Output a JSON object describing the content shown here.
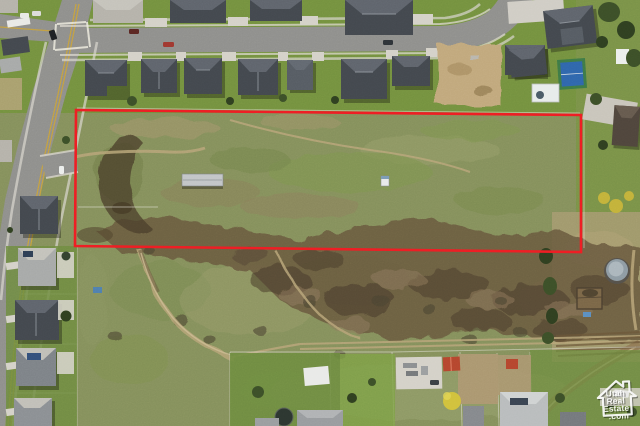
{
  "scene": {
    "type": "aerial-drone-photo",
    "description": "Drone aerial photo of a vacant land parcel outlined in red, bordered by a suburban street of houses on the north, open scrub fields and dirt trails to the south, and neighboring backyards along the bottom",
    "parcel_outline_color": "#ee1d23"
  },
  "watermark": {
    "icon": "house-outline-icon",
    "color": "#ffffff",
    "lines": [
      "Utah",
      "Real",
      "Estate",
      ".com"
    ]
  },
  "palette": {
    "field_green": "#85905c",
    "meadow_green": "#7f9550",
    "lawn_green": "#6e8c3f",
    "dirt_tan": "#b7a47a",
    "rocky_brown": "#6a5a40",
    "asphalt_gray": "#8f8f8c",
    "concrete": "#d4d1c8",
    "roof_dark": "#43484e",
    "outline_red": "#ee1d23",
    "sport_court_blue": "#2f66ac"
  }
}
